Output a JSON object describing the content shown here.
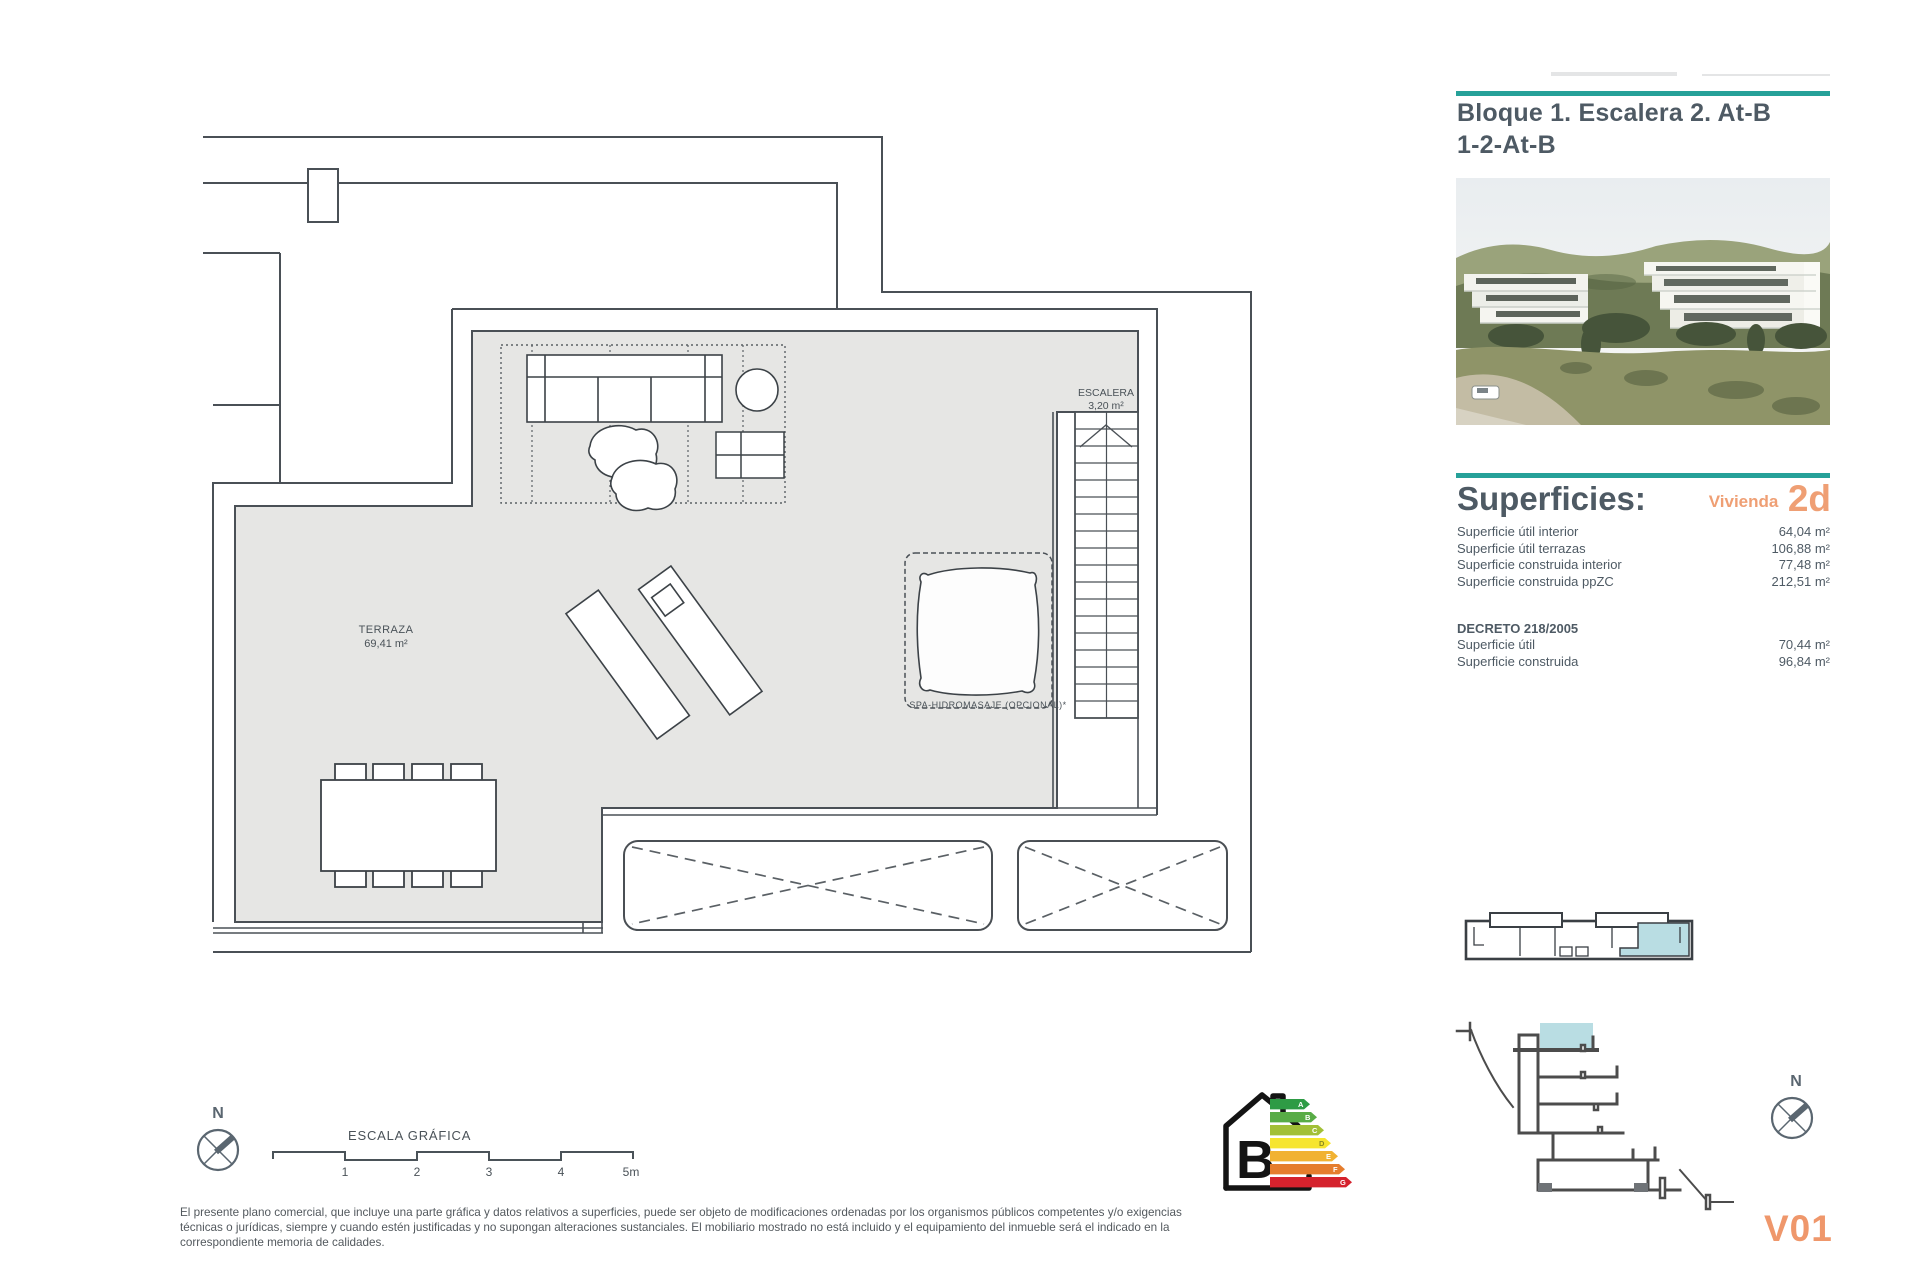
{
  "header": {
    "title_line1": "Bloque 1. Escalera 2. At-B",
    "title_line2": "1-2-At-B"
  },
  "superficies": {
    "heading": "Superficies:",
    "vivienda_label": "Vivienda",
    "vivienda_code": "2d",
    "rows": [
      {
        "label": "Superficie útil interior",
        "value": "64,04 m²"
      },
      {
        "label": "Superficie útil terrazas",
        "value": "106,88 m²"
      },
      {
        "label": "Superficie construida interior",
        "value": "77,48 m²"
      },
      {
        "label": "Superficie construida ppZC",
        "value": "212,51 m²"
      }
    ],
    "decreto_heading": "DECRETO 218/2005",
    "decreto_rows": [
      {
        "label": "Superficie útil",
        "value": "70,44 m²"
      },
      {
        "label": "Superficie construida",
        "value": "96,84 m²"
      }
    ]
  },
  "plan": {
    "terraza_label": "TERRAZA",
    "terraza_area": "69,41 m²",
    "escalera_label": "ESCALERA",
    "escalera_area": "3,20 m²",
    "spa_label": "SPA-HIDROMASAJE (OPCIONAL)*"
  },
  "scale_bar": {
    "title": "ESCALA GRÁFICA",
    "ticks": [
      "1",
      "2",
      "3",
      "4",
      "5m"
    ]
  },
  "north": {
    "label": "N"
  },
  "energy": {
    "letter": "B",
    "scale": [
      "A",
      "B",
      "C",
      "D",
      "E",
      "F",
      "G"
    ]
  },
  "footer": {
    "disclaimer": "El presente plano comercial, que incluye una parte gráfica y datos relativos a superficies, puede ser objeto de modificaciones ordenadas por los organismos públicos competentes y/o exigencias técnicas o jurídicas, siempre y cuando estén justificadas y no supongan alteraciones sustanciales. El mobiliario mostrado no está incluido y el equipamiento del inmueble será el indicado en la correspondiente memoria de calidades.",
    "version": "V01"
  },
  "colors": {
    "teal": "#26a199",
    "orange": "#ef9f74",
    "floor_gray": "#e6e6e4",
    "highlight_blue": "#b9dde3",
    "line": "#4a5056"
  }
}
